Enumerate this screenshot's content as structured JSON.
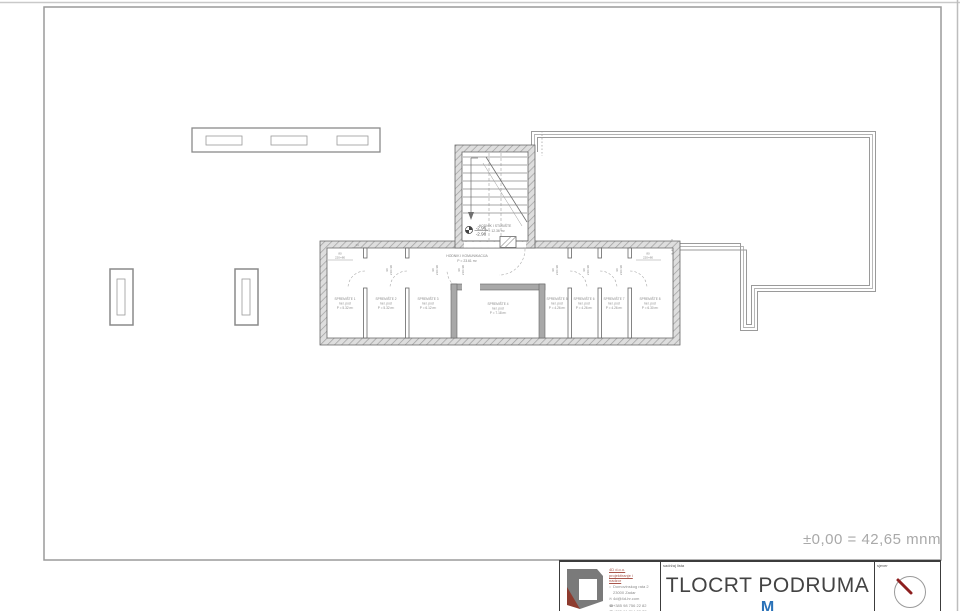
{
  "sheet": {
    "elevation_note": "±0,00 = 42,65 mnm"
  },
  "plan": {
    "corridor": {
      "name": "HODNIK I KOMUNIKACIJA",
      "area": "P = 23.61 m²"
    },
    "stairs": {
      "name": "HODNIK I STUBIŠTE",
      "area": "P = 12.36 m²",
      "level_upper": "-2.96",
      "level_lower": "-2.98"
    },
    "rooms": [
      {
        "name": "SPREMIŠTE 1",
        "floor": "ker. pod",
        "area": "P = 5.32 m²"
      },
      {
        "name": "SPREMIŠTE 2",
        "floor": "ker. pod",
        "area": "P = 5.32 m²"
      },
      {
        "name": "SPREMIŠTE 3",
        "floor": "ker. pod",
        "area": "P = 6.12 m²"
      },
      {
        "name": "SPREMIŠTE 4",
        "floor": "ker. pod",
        "area": "P = 7.18 m²"
      },
      {
        "name": "SPREMIŠTE 5",
        "floor": "ker. pod",
        "area": "P = 4.26 m²"
      },
      {
        "name": "SPREMIŠTE 6",
        "floor": "ker. pod",
        "area": "P = 4.26 m²"
      },
      {
        "name": "SPREMIŠTE 7",
        "floor": "ker. pod",
        "area": "P = 4.26 m²"
      },
      {
        "name": "SPREMIŠTE 8",
        "floor": "ker. pod",
        "area": "P = 6.30 m²"
      }
    ],
    "dims": {
      "window_w": "80",
      "window_size": "220×80",
      "door_w": "90",
      "door_size": "210×90",
      "wall": "14"
    }
  },
  "titleblock": {
    "content_label": "sadržaj lista",
    "title": "TLOCRT PODRUMA",
    "scale_prefix": "M",
    "north_label": "sjever",
    "company": {
      "line1": "4D d.o.o.",
      "line2": "projektiranje i",
      "line3": "nadzor",
      "address1": "Domovinskog rata 2",
      "address2": "23000 Zadar",
      "email": "4d@4d-hr.com",
      "phone1": "+385 98 756 22 82",
      "phone2": "+385 91 714 22 77"
    }
  },
  "colors": {
    "wall_hatch": "#9a9a9a",
    "wall_dark": "#a8a8a8",
    "outline_gray": "#9a9a9a",
    "accent_blue": "#2a72b8",
    "needle_red": "#8d1f1f",
    "logo_gray": "#7a7a7a",
    "logo_red": "#8d3b2e"
  }
}
